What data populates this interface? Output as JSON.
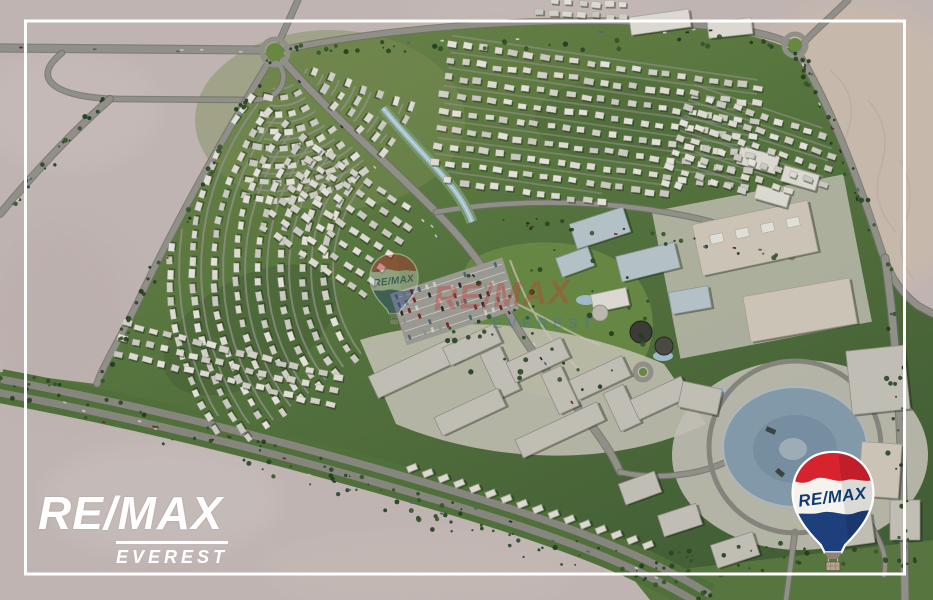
{
  "branding": {
    "agency": {
      "line1": "RE/MAX",
      "line2": "EVEREST"
    },
    "balloon": {
      "label": "RE/MAX"
    },
    "watermark": {
      "line1": "RE/MAX",
      "line2": "EVEREST"
    }
  },
  "colors": {
    "desert": "#cbbfbd",
    "desert_warm": "#d6c4b6",
    "green_main": "#5d7d42",
    "green_light": "#7d9455",
    "green_dark": "#46623a",
    "road": "#97978e",
    "road_casing": "#75756d",
    "villa": "#e9e7de",
    "commercial_gray": "#cbc9c0",
    "commercial_teal": "#bfcdd3",
    "commercial_tan": "#d8d1c2",
    "water": "#a9c6d6",
    "plaza": "#8ba3b5",
    "frame": "#ffffff",
    "logo_white": "#ffffff",
    "balloon_red": "#d6232e",
    "balloon_blue": "#1d3f7b",
    "balloon_white": "#f4f3ee",
    "balloon_text": "#123a75",
    "watermark_red": "#c63a35",
    "watermark_blue": "#3f6fae"
  }
}
